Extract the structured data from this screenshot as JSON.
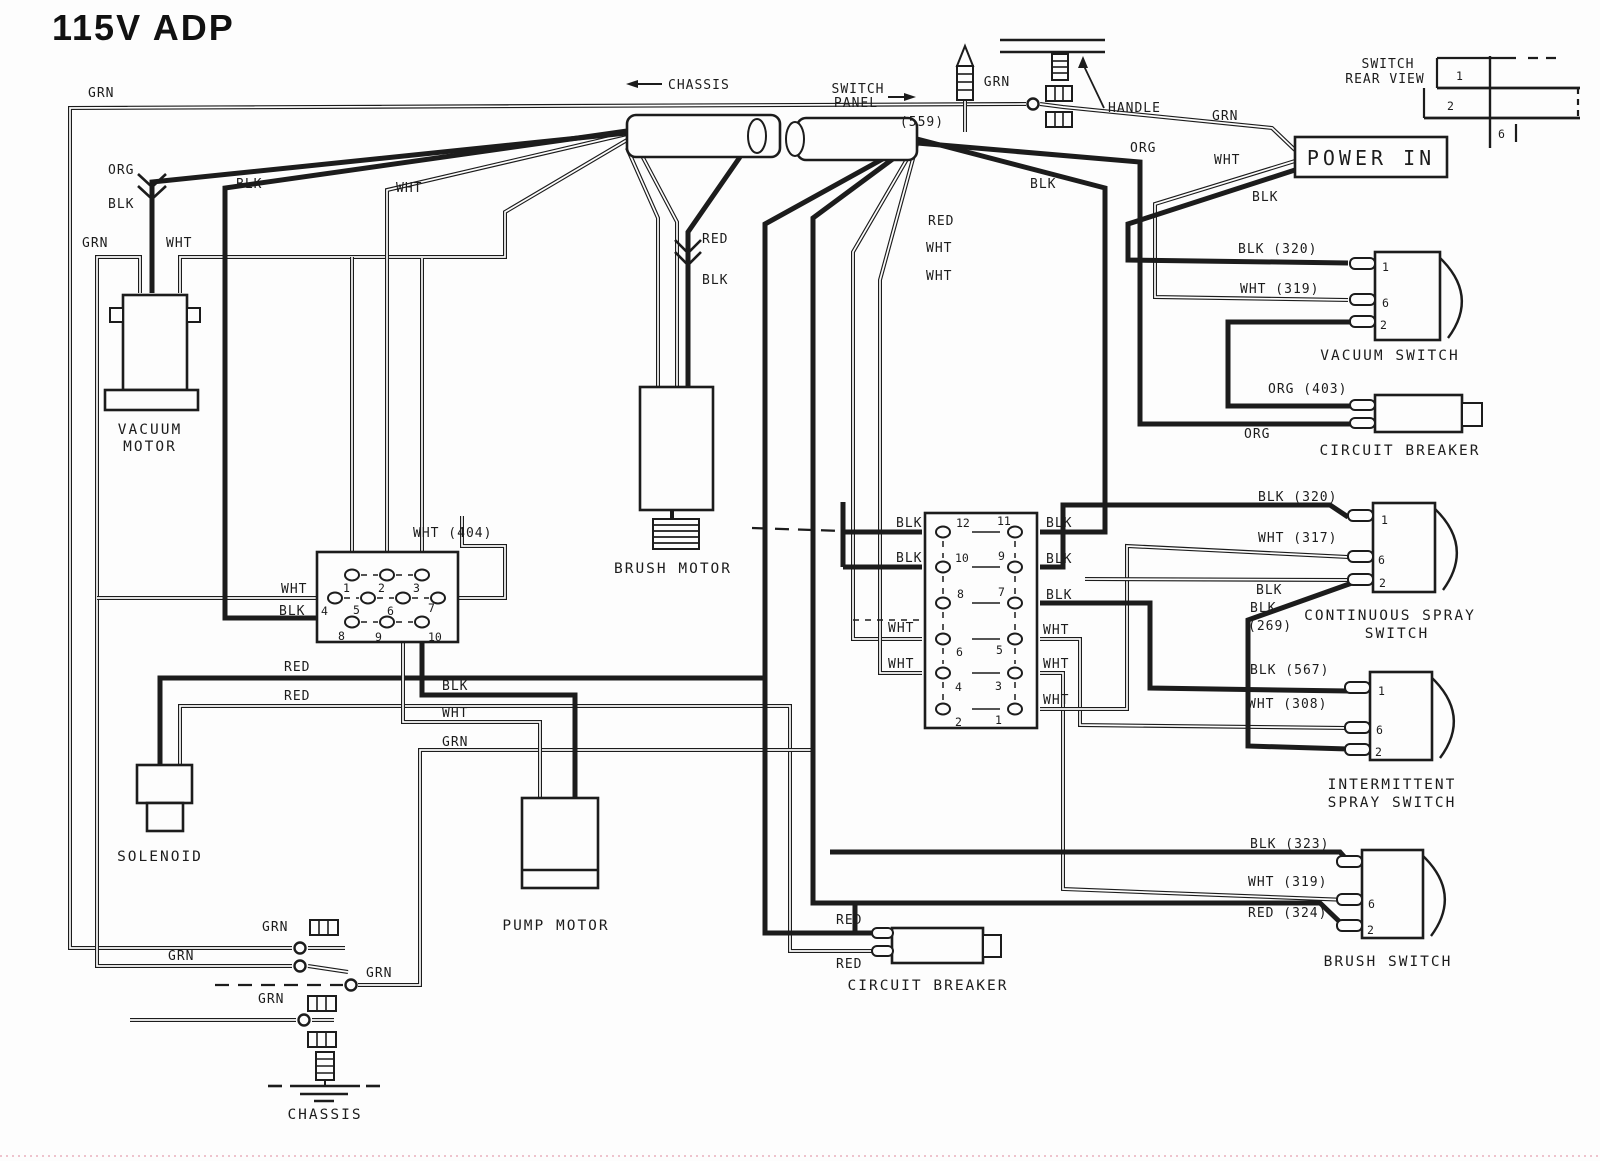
{
  "title": "115V ADP",
  "ink": "#1c1c1c",
  "harness": {
    "chassis": "CHASSIS",
    "switch_panel_1": "SWITCH",
    "switch_panel_2": "PANEL",
    "handle": "HANDLE",
    "grn": "GRN",
    "grn_ref": "(559)"
  },
  "power_in": {
    "label": "POWER IN"
  },
  "rear_view": {
    "line1": "SWITCH",
    "line2": "REAR VIEW",
    "terminals": [
      "1",
      "2",
      "6"
    ]
  },
  "components": {
    "vacuum_motor": {
      "line1": "VACUUM",
      "line2": "MOTOR"
    },
    "brush_motor": {
      "label": "BRUSH MOTOR"
    },
    "solenoid": {
      "label": "SOLENOID"
    },
    "pump_motor": {
      "label": "PUMP MOTOR"
    },
    "chassis_ground": {
      "label": "CHASSIS"
    },
    "circuit_breaker_right": {
      "label": "CIRCUIT BREAKER"
    },
    "circuit_breaker_bottom": {
      "label": "CIRCUIT BREAKER"
    }
  },
  "switches": {
    "vacuum": {
      "label": "VACUUM SWITCH",
      "terminals": [
        "1",
        "6",
        "2"
      ]
    },
    "continuous": {
      "line1": "CONTINUOUS SPRAY",
      "line2": "SWITCH",
      "terminals": [
        "1",
        "6",
        "2"
      ]
    },
    "intermittent": {
      "line1": "INTERMITTENT",
      "line2": "SPRAY SWITCH",
      "terminals": [
        "1",
        "6",
        "2"
      ]
    },
    "brush": {
      "label": "BRUSH SWITCH",
      "terminals": [
        "6",
        "2"
      ]
    }
  },
  "left_block": {
    "terminals": [
      "1",
      "2",
      "3",
      "4",
      "5",
      "6",
      "7",
      "8",
      "9",
      "10"
    ]
  },
  "right_block": {
    "terminals": [
      "12",
      "11",
      "10",
      "9",
      "8",
      "7",
      "6",
      "5",
      "4",
      "3",
      "2",
      "1"
    ]
  },
  "wire_labels": [
    {
      "text": "GRN"
    },
    {
      "text": "ORG"
    },
    {
      "text": "BLK"
    },
    {
      "text": "GRN"
    },
    {
      "text": "WHT"
    },
    {
      "text": "BLK"
    },
    {
      "text": "WHT"
    },
    {
      "text": "RED"
    },
    {
      "text": "BLK"
    },
    {
      "text": "GRN"
    },
    {
      "text": "ORG"
    },
    {
      "text": "WHT"
    },
    {
      "text": "BLK"
    },
    {
      "text": "BLK"
    },
    {
      "text": "RED"
    },
    {
      "text": "WHT"
    },
    {
      "text": "WHT"
    },
    {
      "text": "BLK  (320)"
    },
    {
      "text": "WHT  (319)"
    },
    {
      "text": "ORG  (403)"
    },
    {
      "text": "ORG"
    },
    {
      "text": "WHT (404)"
    },
    {
      "text": "WHT"
    },
    {
      "text": "BLK"
    },
    {
      "text": "RED"
    },
    {
      "text": "RED"
    },
    {
      "text": "BLK"
    },
    {
      "text": "WHT"
    },
    {
      "text": "GRN"
    },
    {
      "text": "BLK"
    },
    {
      "text": "BLK"
    },
    {
      "text": "WHT"
    },
    {
      "text": "WHT"
    },
    {
      "text": "BLK"
    },
    {
      "text": "BLK"
    },
    {
      "text": "BLK"
    },
    {
      "text": "WHT"
    },
    {
      "text": "WHT"
    },
    {
      "text": "WHT"
    },
    {
      "text": "BLK  (320)"
    },
    {
      "text": "WHT  (317)"
    },
    {
      "text": "BLK"
    },
    {
      "text": "BLK"
    },
    {
      "text": "(269)"
    },
    {
      "text": "BLK  (567)"
    },
    {
      "text": "WHT  (308)"
    },
    {
      "text": "BLK  (323)"
    },
    {
      "text": "WHT  (319)"
    },
    {
      "text": "RED  (324)"
    },
    {
      "text": "RED"
    },
    {
      "text": "RED"
    },
    {
      "text": "GRN"
    },
    {
      "text": "GRN"
    },
    {
      "text": "GRN"
    },
    {
      "text": "GRN"
    }
  ]
}
